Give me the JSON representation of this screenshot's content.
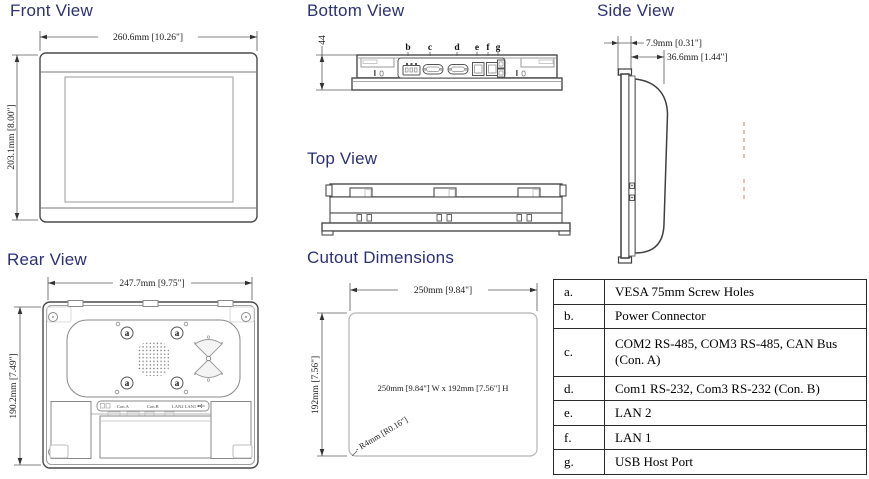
{
  "titles": {
    "front": "Front View",
    "bottom": "Bottom View",
    "side": "Side View",
    "top": "Top View",
    "rear": "Rear View",
    "cutout": "Cutout Dimensions"
  },
  "front": {
    "width_dim": "260.6mm [10.26\"]",
    "height_dim": "203.1mm [8.00\"]"
  },
  "bottom": {
    "height_dim": "44",
    "labels": [
      "b",
      "c",
      "d",
      "e",
      "f",
      "g"
    ]
  },
  "side": {
    "bezel_dim": "7.9mm [0.31\"]",
    "depth_dim": "36.6mm [1.44\"]"
  },
  "rear": {
    "width_dim": "247.7mm [9.75\"]",
    "height_dim": "190.2mm [7.49\"]",
    "screw_label": "a",
    "strip": [
      "Con.A",
      "Con.B",
      "LAN2 LAN1"
    ]
  },
  "cutout": {
    "width_dim": "250mm [9.84\"]",
    "height_dim": "192mm [7.56\"]",
    "center_text": "250mm [9.84\"] W x 192mm [7.56\"] H",
    "radius_text": "- R4mm [R0.16\"]"
  },
  "legend": {
    "rows": [
      {
        "key": "a.",
        "desc": "VESA 75mm Screw Holes"
      },
      {
        "key": "b.",
        "desc": "Power Connector"
      },
      {
        "key": "c.",
        "desc": "COM2 RS-485, COM3 RS-485, CAN Bus (Con. A)"
      },
      {
        "key": "d.",
        "desc": "Com1 RS-232, Com3 RS-232 (Con. B)"
      },
      {
        "key": "e.",
        "desc": "LAN 2"
      },
      {
        "key": "f.",
        "desc": "LAN 1"
      },
      {
        "key": "g.",
        "desc": "USB Host Port"
      }
    ]
  },
  "colors": {
    "title": "#2b3173",
    "line": "#4a4a4a"
  }
}
